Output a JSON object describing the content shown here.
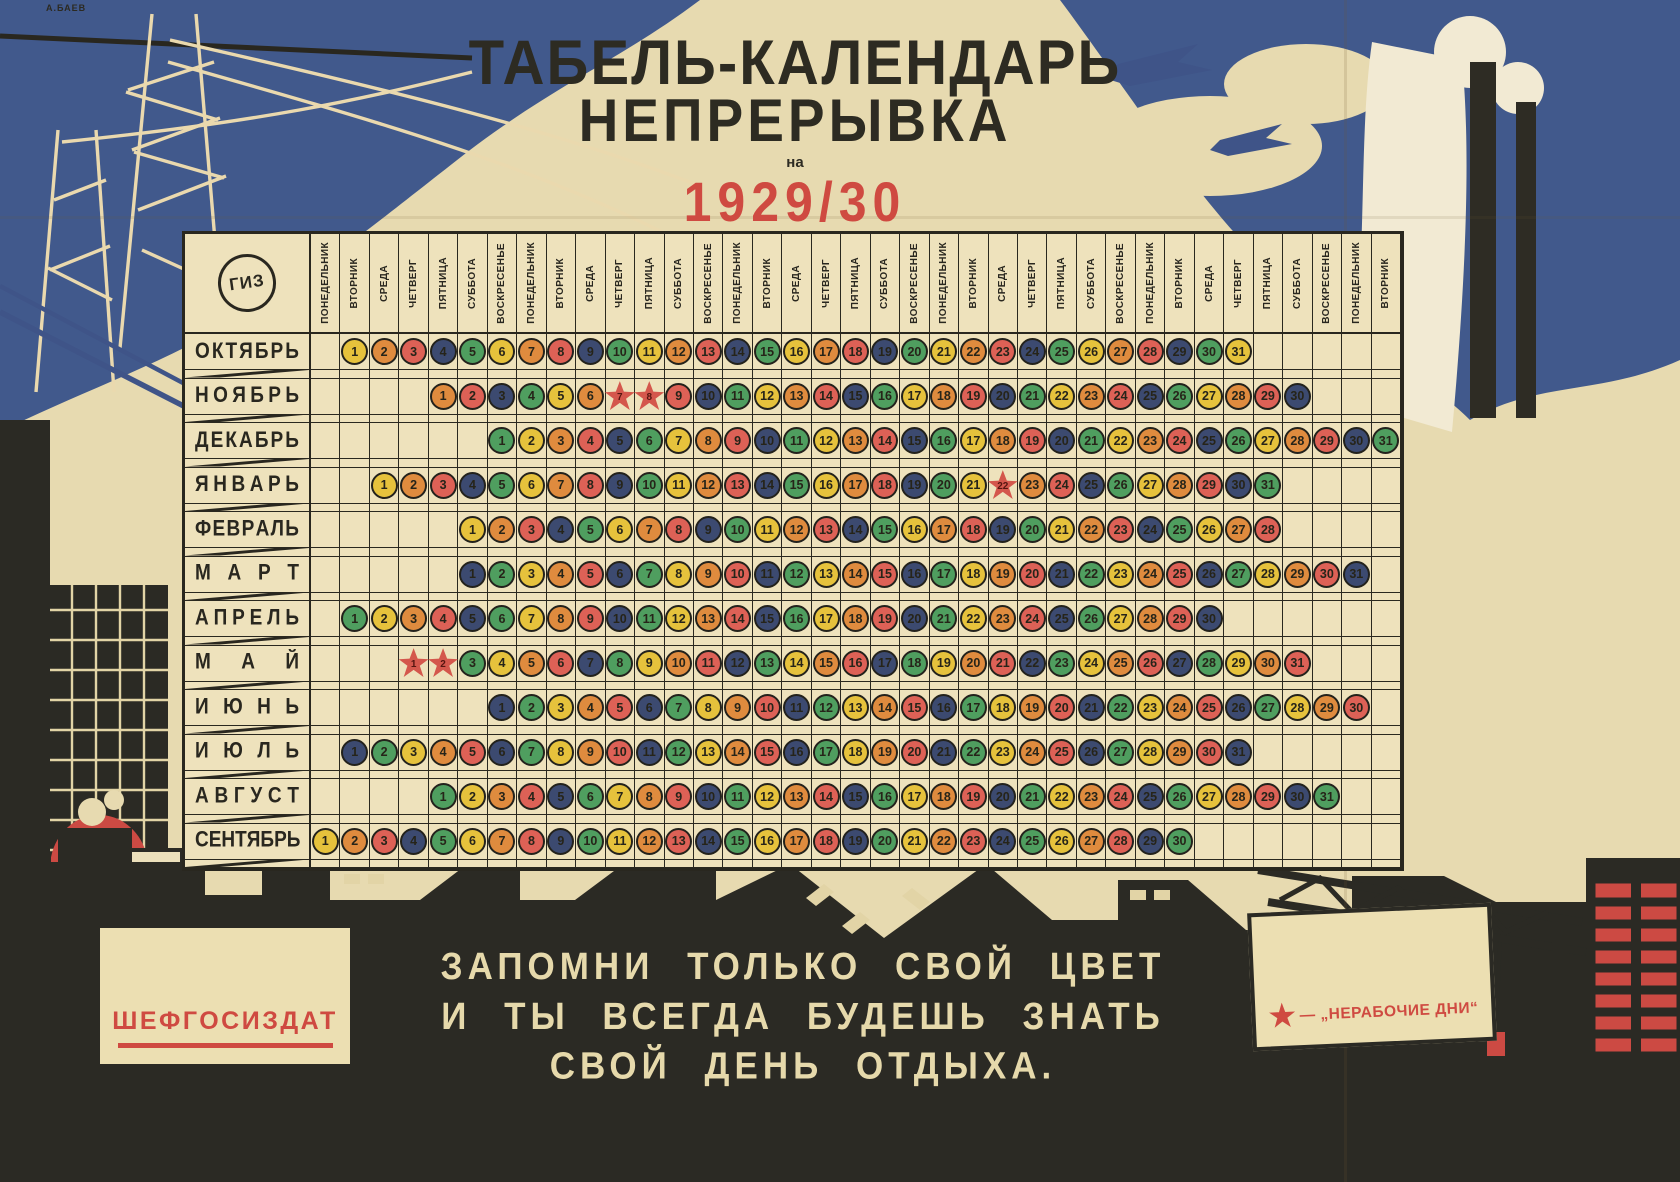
{
  "artist_signature": "А.БАЕВ",
  "colors": {
    "paper": "#e7dab0",
    "table_paper": "#eee2bc",
    "ink": "#29271f",
    "sky_blue": "#41598c",
    "accent_red": "#cf4a41",
    "smoke_white": "#f2ead3"
  },
  "title": {
    "line1": "ТАБЕЛЬ-КАЛЕНДАРЬ",
    "line2": "НЕПРЕРЫВКА",
    "preposition": "на",
    "year": "1929/30",
    "subtitle": "ХОЗЯЙСТВЕННЫЙ ГОД"
  },
  "calendar": {
    "logo": "ГИЗ",
    "weekdays": [
      "ПОНЕДЕЛЬНИК",
      "ВТОРНИК",
      "СРЕДА",
      "ЧЕТВЕРГ",
      "ПЯТНИЦА",
      "СУББОТА",
      "ВОСКРЕСЕНЬЕ"
    ],
    "num_columns": 37,
    "day_color_cycle": [
      "#e6c23c",
      "#df8b3e",
      "#dd6156",
      "#3c4a70",
      "#4f9e5f"
    ],
    "holiday_star_color": "#d4574c",
    "months": [
      {
        "name": "ОКТЯБРЬ",
        "start_col": 2,
        "days": 31,
        "holidays": []
      },
      {
        "name": "НОЯБРЬ",
        "start_col": 5,
        "days": 30,
        "holidays": [
          7,
          8
        ]
      },
      {
        "name": "ДЕКАБРЬ",
        "start_col": 7,
        "days": 31,
        "holidays": []
      },
      {
        "name": "ЯНВАРЬ",
        "start_col": 3,
        "days": 31,
        "holidays": [
          22
        ]
      },
      {
        "name": "ФЕВРАЛЬ",
        "start_col": 6,
        "days": 28,
        "holidays": []
      },
      {
        "name": "МАРТ",
        "start_col": 6,
        "days": 31,
        "holidays": []
      },
      {
        "name": "АПРЕЛЬ",
        "start_col": 2,
        "days": 30,
        "holidays": []
      },
      {
        "name": "МАЙ",
        "start_col": 4,
        "days": 31,
        "holidays": [
          1,
          2
        ]
      },
      {
        "name": "ИЮНЬ",
        "start_col": 7,
        "days": 30,
        "holidays": []
      },
      {
        "name": "ИЮЛЬ",
        "start_col": 2,
        "days": 31,
        "holidays": []
      },
      {
        "name": "АВГУСТ",
        "start_col": 5,
        "days": 31,
        "holidays": []
      },
      {
        "name": "СЕНТЯБРЬ",
        "start_col": 1,
        "days": 30,
        "holidays": []
      }
    ]
  },
  "footer": {
    "slogan": [
      "ЗАПОМНИ ТОЛЬКО СВОЙ ЦВЕТ",
      "И ТЫ ВСЕГДА БУДЕШЬ ЗНАТЬ",
      "СВОЙ ДЕНЬ ОТДЫХА."
    ],
    "publisher": "ШЕФГОСИЗДАТ",
    "legend": {
      "star": "★",
      "text": "— „НЕРАБОЧИЕ ДНИ“"
    }
  }
}
